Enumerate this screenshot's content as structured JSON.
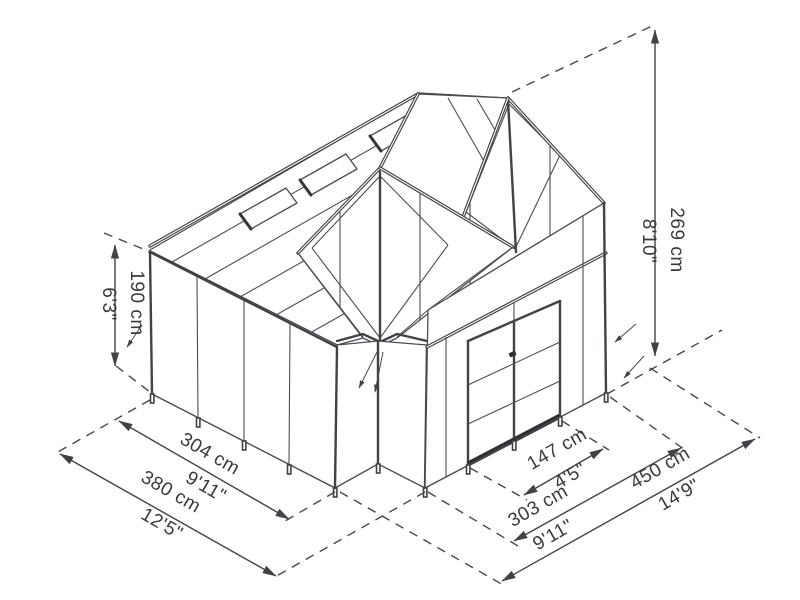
{
  "diagram": {
    "title": "greenhouse-dimension-diagram",
    "style": "isometric-wireframe",
    "line_color": "#44484c",
    "text_color": "#3a3a3a",
    "background": "#ffffff"
  },
  "dims": {
    "wall_height": {
      "cm": "190 cm",
      "ft": "6'3\""
    },
    "total_height": {
      "cm": "269 cm",
      "ft": "8'10\""
    },
    "side_panel": {
      "cm": "304 cm",
      "ft": "9'11\""
    },
    "total_depth": {
      "cm": "380 cm",
      "ft": "12'5\""
    },
    "door_section": {
      "cm": "147 cm",
      "ft": "4'5\""
    },
    "front_wall": {
      "cm": "303 cm",
      "ft": "9'11\""
    },
    "total_width": {
      "cm": "450 cm",
      "ft": "14'9\""
    }
  }
}
